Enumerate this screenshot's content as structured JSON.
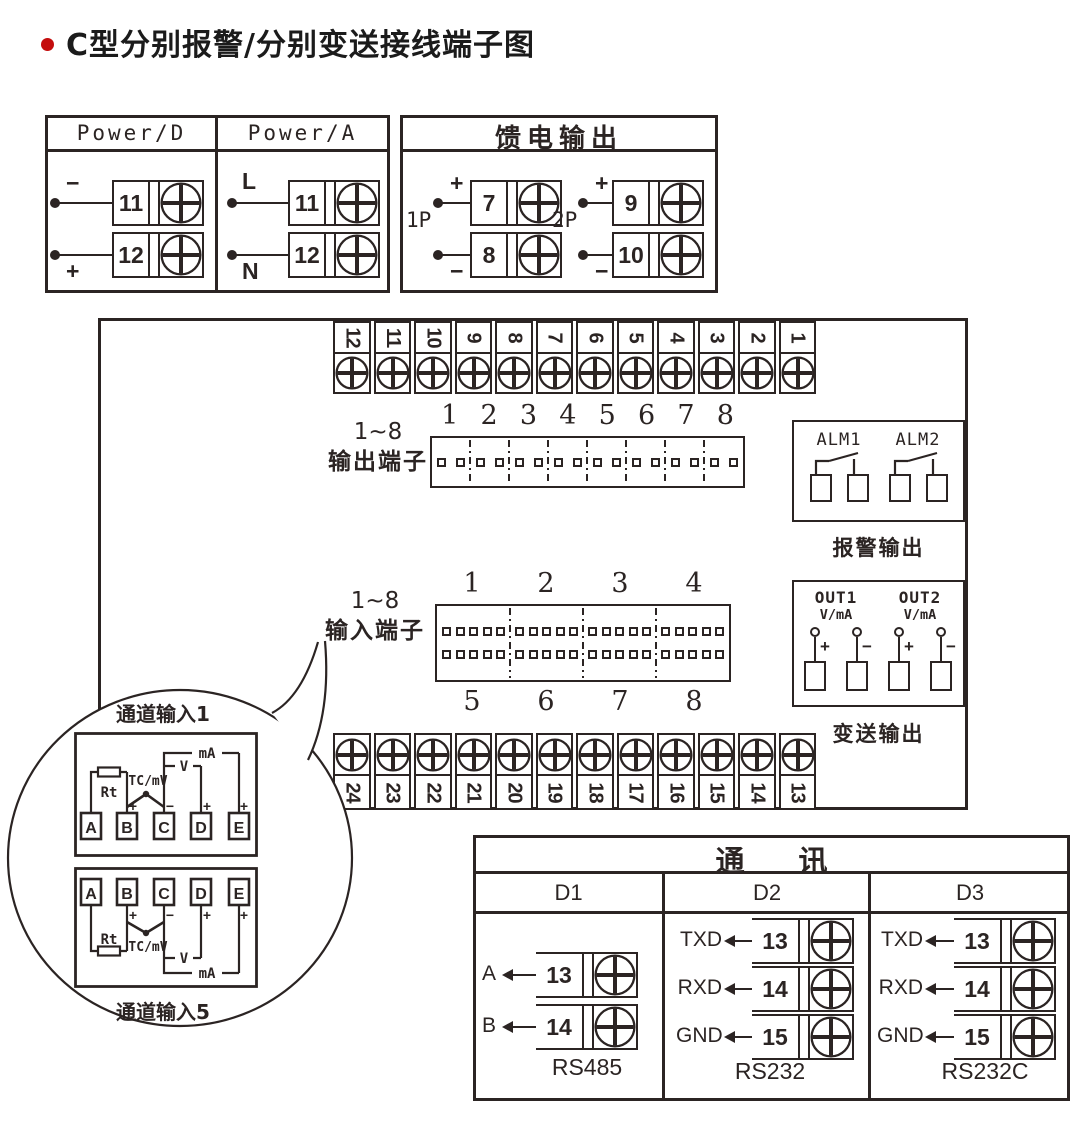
{
  "page": {
    "title": "C型分别报警/分别变送接线端子图"
  },
  "power_box": {
    "columns": [
      {
        "header": "Power/D",
        "terminals": [
          {
            "sign": "−",
            "number": "11"
          },
          {
            "sign": "+",
            "number": "12"
          }
        ]
      },
      {
        "header": "Power/A",
        "terminals": [
          {
            "sign": "L",
            "number": "11"
          },
          {
            "sign": "N",
            "number": "12"
          }
        ]
      }
    ]
  },
  "feed_box": {
    "title": "馈电输出",
    "groups": [
      {
        "name": "1P",
        "terminals": [
          {
            "sign": "+",
            "number": "7"
          },
          {
            "sign": "−",
            "number": "8"
          }
        ]
      },
      {
        "name": "2P",
        "terminals": [
          {
            "sign": "+",
            "number": "9"
          },
          {
            "sign": "−",
            "number": "10"
          }
        ]
      }
    ]
  },
  "main_panel": {
    "top_strip": [
      "12",
      "11",
      "10",
      "9",
      "8",
      "7",
      "6",
      "5",
      "4",
      "3",
      "2",
      "1"
    ],
    "bottom_strip": [
      "24",
      "23",
      "22",
      "21",
      "20",
      "19",
      "18",
      "17",
      "16",
      "15",
      "14",
      "13"
    ],
    "output_block": {
      "label_range": "1~8",
      "label_name": "输出端子",
      "numbers": [
        "1",
        "2",
        "3",
        "4",
        "5",
        "6",
        "7",
        "8"
      ]
    },
    "input_block": {
      "label_range": "1~8",
      "label_name": "输入端子",
      "numbers_top": [
        "1",
        "2",
        "3",
        "4"
      ],
      "numbers_bottom": [
        "5",
        "6",
        "7",
        "8"
      ]
    },
    "alarm_box": {
      "groups": [
        "ALM1",
        "ALM2"
      ],
      "caption": "报警输出"
    },
    "transmit_box": {
      "groups": [
        {
          "name": "OUT1",
          "signal": "V/mA"
        },
        {
          "name": "OUT2",
          "signal": "V/mA"
        }
      ],
      "plus": "+",
      "minus": "−",
      "caption": "变送输出"
    }
  },
  "balloon": {
    "channel_top": {
      "caption": "通道输入1",
      "terminals": [
        "A",
        "B",
        "C",
        "D",
        "E"
      ],
      "rt": "Rt",
      "tc": "TC/mV",
      "v": "V",
      "ma": "mA",
      "signs": {
        "b": "+",
        "c": "−",
        "d": "+",
        "e": "+"
      }
    },
    "channel_bottom": {
      "caption": "通道输入5",
      "terminals": [
        "A",
        "B",
        "C",
        "D",
        "E"
      ],
      "rt": "Rt",
      "tc": "TC/mV",
      "v": "V",
      "ma": "mA",
      "signs": {
        "b": "+",
        "c": "−",
        "d": "+",
        "e": "+"
      }
    }
  },
  "comm_box": {
    "title": "通 讯",
    "columns": [
      {
        "name": "D1",
        "bus": "RS485",
        "terminals": [
          {
            "label": "A",
            "number": "13"
          },
          {
            "label": "B",
            "number": "14"
          }
        ]
      },
      {
        "name": "D2",
        "bus": "RS232",
        "terminals": [
          {
            "label": "TXD",
            "number": "13"
          },
          {
            "label": "RXD",
            "number": "14"
          },
          {
            "label": "GND",
            "number": "15"
          }
        ]
      },
      {
        "name": "D3",
        "bus": "RS232C",
        "terminals": [
          {
            "label": "TXD",
            "number": "13"
          },
          {
            "label": "RXD",
            "number": "14"
          },
          {
            "label": "GND",
            "number": "15"
          }
        ]
      }
    ]
  }
}
